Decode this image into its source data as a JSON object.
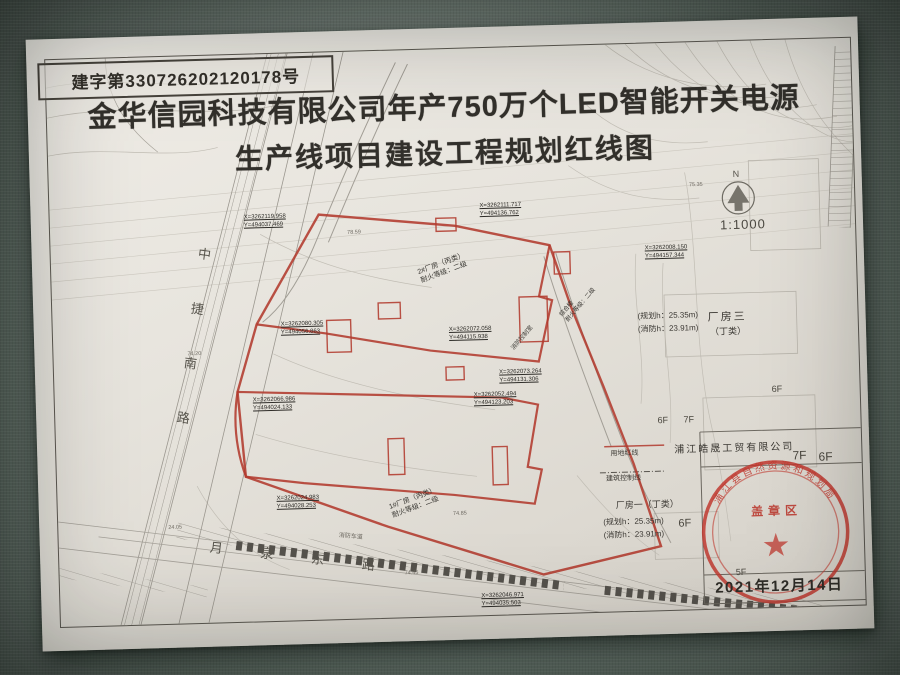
{
  "page": {
    "permit_no": "建字第330726202120178号",
    "title_line1": "金华信园科技有限公司年产750万个LED智能开关电源",
    "title_line2": "生产线项目建设工程规划红线图",
    "scale": "1:1000",
    "north": "N",
    "date": "2021年12月14日"
  },
  "roads": {
    "west": "中捷南路",
    "south": "月泉东路"
  },
  "legend": {
    "site_line": "用地红线",
    "control_line": "建筑控制线"
  },
  "labels": {
    "b2": "2#厂房（丙类）",
    "b2_fire": "耐火等级：二级",
    "b1": "1#厂房（丙类）",
    "b1_fire": "耐火等级：二级",
    "complex": "综合楼",
    "complex_fire": "耐火等级：二级",
    "fire_control": "消防控制室",
    "fire_lane": "消防车道",
    "plant3": "厂房三",
    "plant3_class": "（丁类）",
    "plant3_plan_h": "(规划h：25.35m)",
    "plant3_fire_h": "(消防h：23.91m)",
    "plant1": "厂房一（丁类）",
    "plant1_plan_h": "(规划h：25.35m)",
    "plant1_fire_h": "(消防h：23.91m)",
    "neighbor_company": "浦江皓晟工贸有限公司",
    "stamp_area": "盖章区",
    "seal_arc": "浦江县自然资源和规划局",
    "seal_star": "★"
  },
  "coords": [
    {
      "l1": "X=3262119.958",
      "l2": "Y=494037.469"
    },
    {
      "l1": "X=3262111.717",
      "l2": "Y=494136.762"
    },
    {
      "l1": "X=3262008.150",
      "l2": "Y=494157.344"
    },
    {
      "l1": "X=3262080.305",
      "l2": "Y=494056.863"
    },
    {
      "l1": "X=3262072.058",
      "l2": "Y=494115.938"
    },
    {
      "l1": "X=3262073.264",
      "l2": "Y=494131.306"
    },
    {
      "l1": "X=3262052.494",
      "l2": "Y=494123.203"
    },
    {
      "l1": "X=3262066.986",
      "l2": "Y=494024.133"
    },
    {
      "l1": "X=3262024.983",
      "l2": "Y=494028.253"
    },
    {
      "l1": "X=3262046.971",
      "l2": "Y=494035.503"
    }
  ],
  "floors": [
    "6F",
    "7F",
    "6F",
    "7F",
    "6F",
    "6F",
    "5F"
  ],
  "spots": [
    "74.20",
    "24.05",
    "74.85",
    "74.45",
    "78.59",
    "75.35"
  ]
}
